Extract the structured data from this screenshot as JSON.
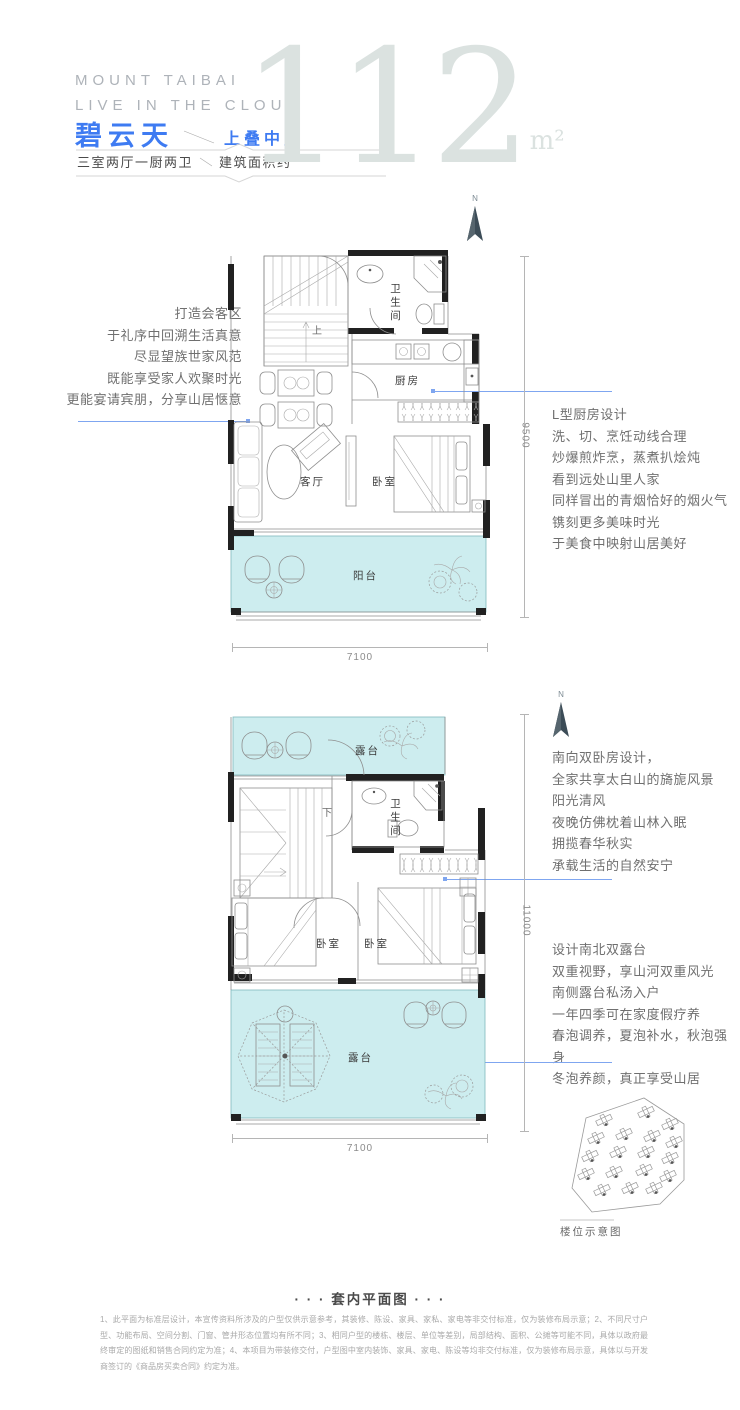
{
  "colors": {
    "accent": "#3E7BF2",
    "plan_fill": "#CDEDEF",
    "leader": "#7FA6F0",
    "big_number": "#DBE2E0"
  },
  "header": {
    "brand_line1": "MOUNT TAIBAI",
    "brand_line2": "LIVE IN THE CLOUD",
    "product_name": "碧云天",
    "unit_type": "上叠中户",
    "spec": "三室两厅一厨两卫",
    "area_prefix": "建筑面积约",
    "area_value": "112",
    "area_unit": "m²"
  },
  "annotations": {
    "living": {
      "lines": [
        "打造会客区",
        "于礼序中回溯生活真意",
        "尽显望族世家风范",
        "既能享受家人欢聚时光",
        "更能宴请宾朋，分享山居惬意"
      ]
    },
    "kitchen": {
      "lines": [
        "L型厨房设计",
        "洗、切、烹饪动线合理",
        "炒爆煎炸烹，蒸煮扒烩炖",
        "看到远处山里人家",
        "同样冒出的青烟恰好的烟火气",
        "镌刻更多美味时光",
        "于美食中映射山居美好"
      ]
    },
    "bedrooms": {
      "lines": [
        "南向双卧房设计，",
        "全家共享太白山的旖旎风景",
        "阳光清风",
        "夜晚仿佛枕着山林入眠",
        "拥揽春华秋实",
        "承载生活的自然安宁"
      ]
    },
    "terrace": {
      "lines": [
        "设计南北双露台",
        "双重视野，享山河双重风光",
        "南侧露台私汤入户",
        "一年四季可在家度假疗养",
        "春泡调养，夏泡补水，秋泡强身",
        "冬泡养颜，真正享受山居"
      ]
    }
  },
  "plan_upper": {
    "compass": "N",
    "rooms": {
      "bathroom": "卫生间",
      "kitchen": "厨房",
      "living": "客厅",
      "bedroom": "卧室",
      "balcony": "阳台",
      "stair": "上"
    },
    "dim_width": "7100",
    "dim_height": "9500"
  },
  "plan_lower": {
    "compass": "N",
    "rooms": {
      "terrace_top": "露台",
      "bathroom": "卫生间",
      "stair": "下",
      "bedroom_left": "卧室",
      "bedroom_right": "卧室",
      "terrace_bottom": "露台"
    },
    "dim_width": "7100",
    "dim_height": "11000"
  },
  "site": {
    "caption": "楼位示意图"
  },
  "footer": {
    "title": "· · · 套内平面图 · · ·",
    "disclaimer": "1、此平面为标准层设计，本宣传资料所涉及的户型仅供示意参考，其装修、陈设、家具、家私、家电等非交付标准，仅为装修布局示意；2、不同尺寸户型、功能布局、空间分割、门窗、管井形态位置均有所不同；3、相同户型的楼栋、楼层、单位等差别，局部结构、面积、公摊等可能不同，具体以政府最终审定的图纸和销售合同约定为准；4、本项目为带装修交付，户型图中室内装饰、家具、家电、陈设等均非交付标准，仅为装修布局示意，具体以与开发商签订的《商品房买卖合同》约定为准。"
  }
}
